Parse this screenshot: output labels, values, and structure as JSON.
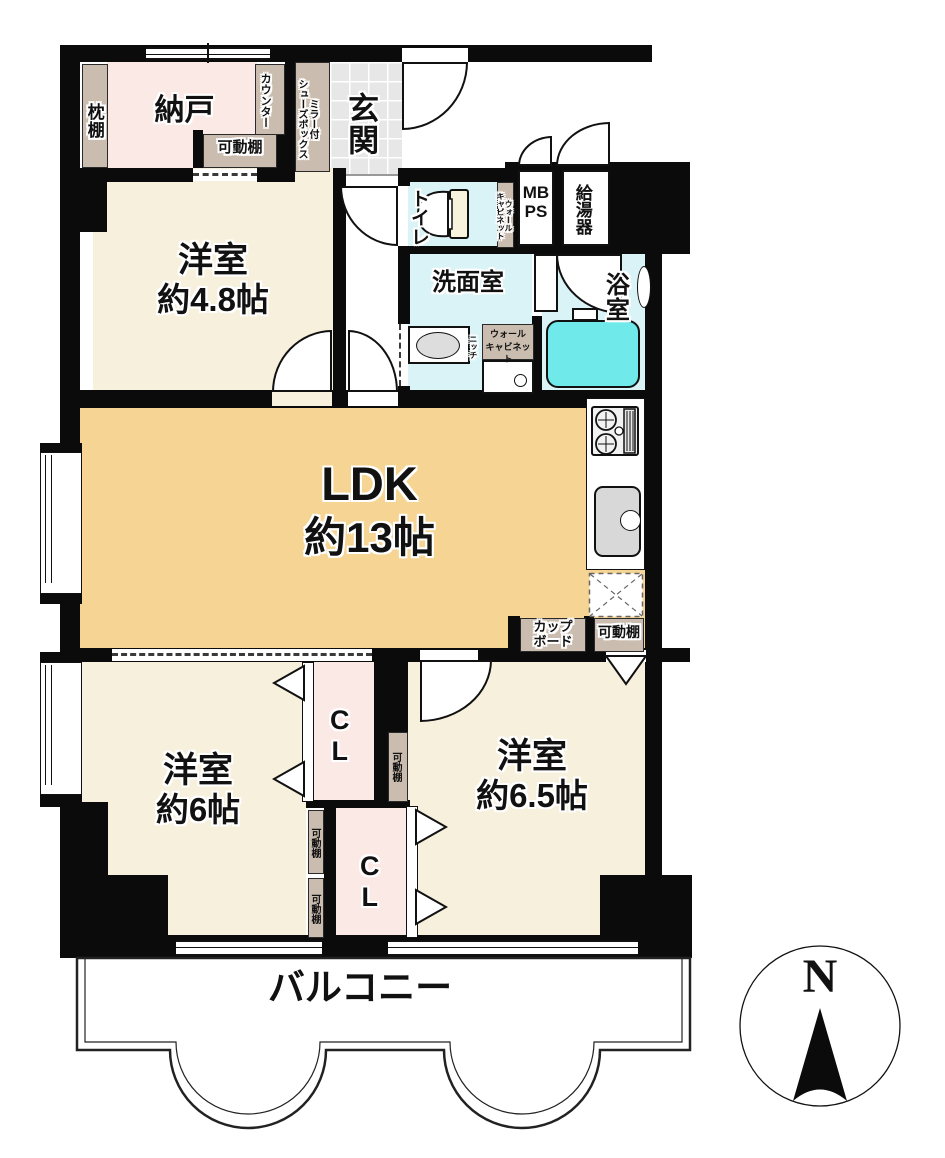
{
  "floorplan": {
    "entrance": {
      "genkan": "玄関",
      "shoes_box_line1": "ミラー付",
      "shoes_box_line2": "シューズボックス"
    },
    "storage": {
      "nando": "納戸",
      "makuradana": "枕棚",
      "counter": "カウンター",
      "kadou_dana": "可動棚",
      "closet": "CL",
      "cupboard_line1": "カップ",
      "cupboard_line2": "ボード"
    },
    "sanitary": {
      "toilet": "トイレ",
      "washroom": "洗面室",
      "bathroom": "浴室",
      "wall_cabinet_line1": "ウォール",
      "wall_cabinet_line2": "キャビネット",
      "niche": "ニッチ",
      "mb": "MB",
      "ps": "PS",
      "water_heater": "給湯器"
    },
    "rooms": {
      "western_room_48": {
        "name": "洋室",
        "size": "約4.8帖"
      },
      "ldk": {
        "name": "LDK",
        "size": "約13帖"
      },
      "western_room_6": {
        "name": "洋室",
        "size": "約6帖"
      },
      "western_room_65": {
        "name": "洋室",
        "size": "約6.5帖"
      }
    },
    "balcony": "バルコニー",
    "compass_north": "N",
    "colors": {
      "wall": "#0b0b0b",
      "room_cream": "#f7f0dd",
      "ldk_orange": "#f6d493",
      "closet_pink": "#fbe9e6",
      "wet_area_blue": "#daf3f6",
      "bathtub_cyan": "#6fe9ea",
      "shelf_tan": "#cabdaf",
      "entry_tile_gray": "#e7e7e7"
    }
  }
}
